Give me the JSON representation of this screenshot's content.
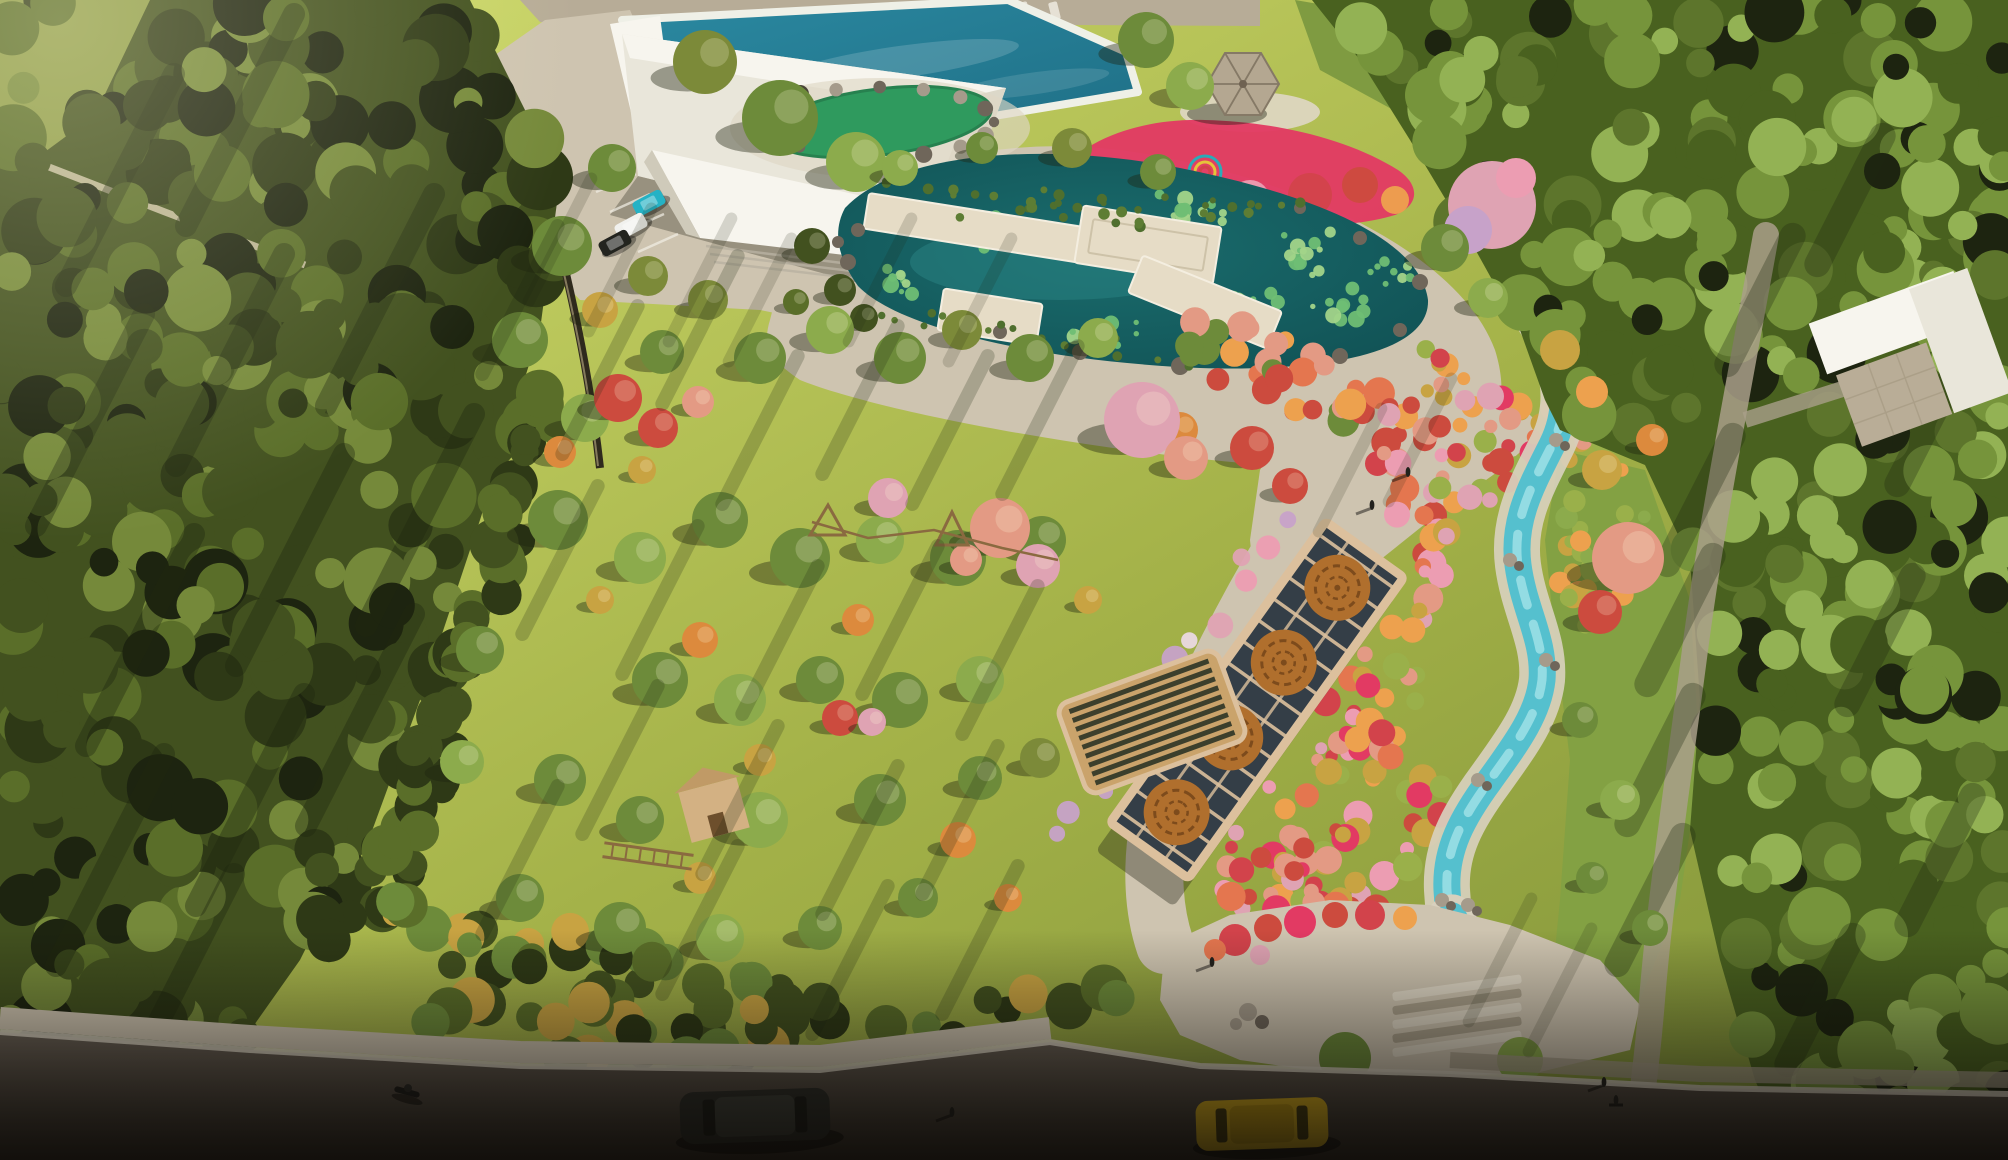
{
  "scene": {
    "type": "aerial-architectural-render",
    "features": [
      "left-woodland",
      "hill-trail",
      "boundary-wall",
      "sunlit-meadow",
      "meadow-trees",
      "playground",
      "rope-course",
      "play-hut",
      "rope-bridge",
      "wooden-lounger",
      "pergola-walk",
      "pergola-medallions",
      "swimming-pool",
      "service-building",
      "parking-lot",
      "parked-cars",
      "green-pond",
      "lotus-pond",
      "boardwalk-decks",
      "lily-pads",
      "chinese-pavilion",
      "flower-garden",
      "flower-sculpture",
      "cherry-tree",
      "stream",
      "autumn-shrub-garden",
      "east-lawn",
      "right-woodland",
      "forest-path",
      "courtyard-building",
      "central-plaza",
      "entrance-plaza",
      "entrance-steps",
      "street",
      "sidewalk",
      "dark-car",
      "yellow-car",
      "motorcycle",
      "pedestrians",
      "crosswalk"
    ]
  },
  "palette": {
    "meadow_sun": "#d2dd6e",
    "meadow_base": "#a3b148",
    "meadow_shade": "#7e9138",
    "forest_dark": "#2e3916",
    "forest_mid": "#42511f",
    "forest_light": "#5a6e29",
    "forest_hi": "#75893a",
    "rforest_base": "#49611f",
    "rforest_mid": "#5d752c",
    "rforest_light": "#76943b",
    "rforest_hi": "#93b254",
    "canopy_shadow": "#1d2410",
    "hill_grass": "#8d9c47",
    "lawn_east": "#83a143",
    "pav_lawn": "#7f9b41",
    "pavement": "#cec4b0",
    "pavement_light": "#dfd7c5",
    "pavement_shade": "#a99f8a",
    "road": "#6a6156",
    "road_dark": "#3a332b",
    "curb": "#d9d1c1",
    "top_road": "#b7ac97",
    "pool_water": "#2b89a1",
    "pool_deep": "#1e6e85",
    "pool_rim": "#eff0e7",
    "pond_water": "#1a6c6d",
    "pond_deep": "#104f52",
    "lily": "#6fbe74",
    "lily_light": "#a2d489",
    "reed": "#4f6f2e",
    "green_pond": "#2f9a5e",
    "green_pond_rim": "#27814f",
    "stream_water": "#55c0ce",
    "stream_core": "#9fe0e6",
    "stream_margin": "#d8d0bd",
    "stream_deep": "#2f9fb0",
    "rock": "#a59b8b",
    "rock_dark": "#6f665a",
    "bldg_wall": "#e9e6da",
    "bldg_lit": "#f7f5ee",
    "bldg_shade": "#dcd8c9",
    "bldg_shade2": "#cfcaba",
    "courtyard": "#b9ad97",
    "pav_roof": "#b4a791",
    "pav_roof_dark": "#857966",
    "finial": "#6f6252",
    "fl_magenta": "#e23a63",
    "fl_crimson": "#d2434b",
    "fl_coral": "#e4764f",
    "fl_orange": "#eda14e",
    "fl_pink": "#ec9db2",
    "fl_lilac": "#c7a2c9",
    "fl_yellow": "#d6ca52",
    "fl_white": "#ead9e2",
    "aut_red": "#cc4b3e",
    "aut_orange": "#dc8a3d",
    "aut_salmon": "#e39a84",
    "aut_pink": "#dfa3b3",
    "aut_gold": "#c8a342",
    "tree_green": "#6d8b3a",
    "tree_green_light": "#8cab4c",
    "tree_olive": "#7c8a39",
    "perg_frame": "#dcc09d",
    "perg_dark": "#343e47",
    "perg_medal": "#b06f2d",
    "perg_medal_dark": "#7d4b1c",
    "wood": "#d3b183",
    "wood_dark": "#8a6a40",
    "lounger": "#caa36b",
    "lounger_slat": "#3c3f2c",
    "car_teal": "#25b2c5",
    "car_white": "#f1f1ee",
    "car_black": "#23241f",
    "car_grey": "#2f302b",
    "car_grey_roof": "#41433c",
    "car_yellow": "#e5b81e",
    "car_yellow_roof": "#caa014",
    "person": "#23221e"
  }
}
